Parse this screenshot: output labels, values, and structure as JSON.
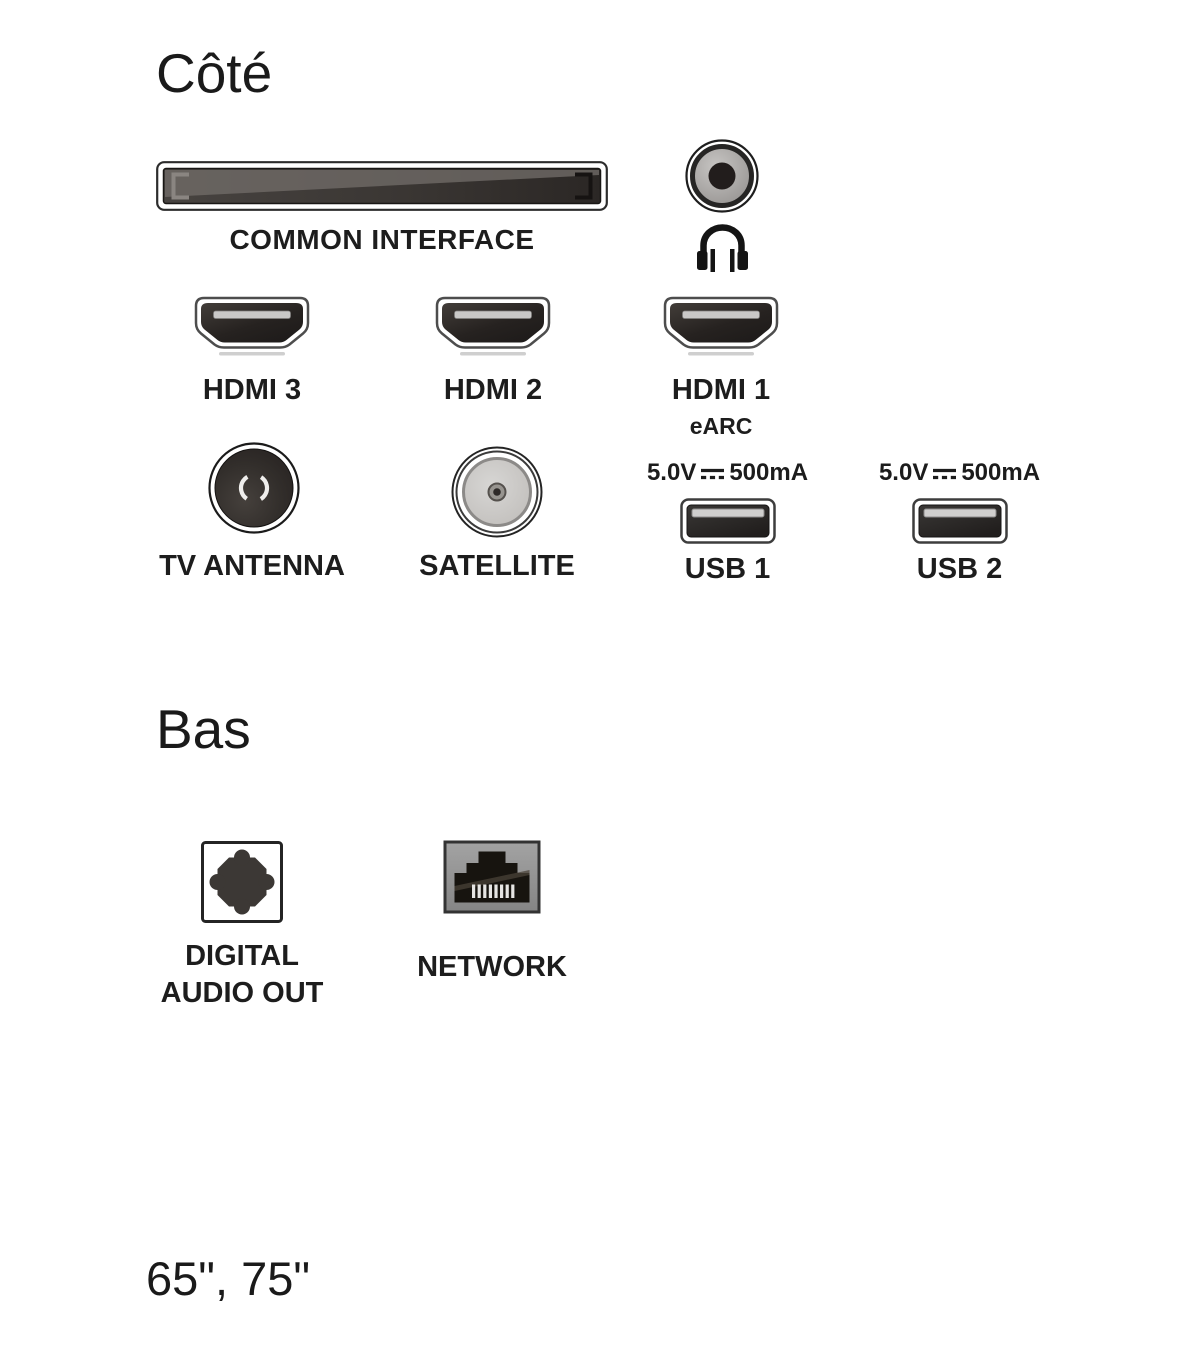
{
  "page": {
    "background": "#ffffff",
    "text_color": "#1c1c1c"
  },
  "side": {
    "title": "Côté",
    "common_interface": {
      "label": "COMMON INTERFACE",
      "icon": "ci-slot-icon"
    },
    "headphone": {
      "jack_icon": "headphone-jack-icon",
      "icon": "headphones-icon"
    },
    "hdmi_ports": [
      {
        "label": "HDMI 3",
        "sublabel": "",
        "icon": "hdmi-port-icon"
      },
      {
        "label": "HDMI 2",
        "sublabel": "",
        "icon": "hdmi-port-icon"
      },
      {
        "label": "HDMI 1",
        "sublabel": "eARC",
        "icon": "hdmi-port-icon"
      }
    ],
    "antenna": {
      "label": "TV ANTENNA",
      "icon": "coax-antenna-icon"
    },
    "satellite": {
      "label": "SATELLITE",
      "icon": "satellite-f-connector-icon"
    },
    "usb_ports": [
      {
        "voltage": "5.0V",
        "current": "500mA",
        "label": "USB 1",
        "icon": "usb-port-icon",
        "dc_symbol_icon": "dc-power-symbol-icon"
      },
      {
        "voltage": "5.0V",
        "current": "500mA",
        "label": "USB 2",
        "icon": "usb-port-icon",
        "dc_symbol_icon": "dc-power-symbol-icon"
      }
    ]
  },
  "bottom": {
    "title": "Bas",
    "digital_audio_out": {
      "line1": "DIGITAL",
      "line2": "AUDIO OUT",
      "icon": "optical-audio-icon"
    },
    "network": {
      "label": "NETWORK",
      "icon": "rj45-network-icon"
    }
  },
  "footer": {
    "sizes": "65\", 75\""
  },
  "colors": {
    "port_black": "#232021",
    "port_border_gray": "#4d4d4d",
    "metal_light_gray": "#c9c8c7",
    "connector_body_gray": "#989593",
    "rj45_housing_gray": "#969696"
  }
}
